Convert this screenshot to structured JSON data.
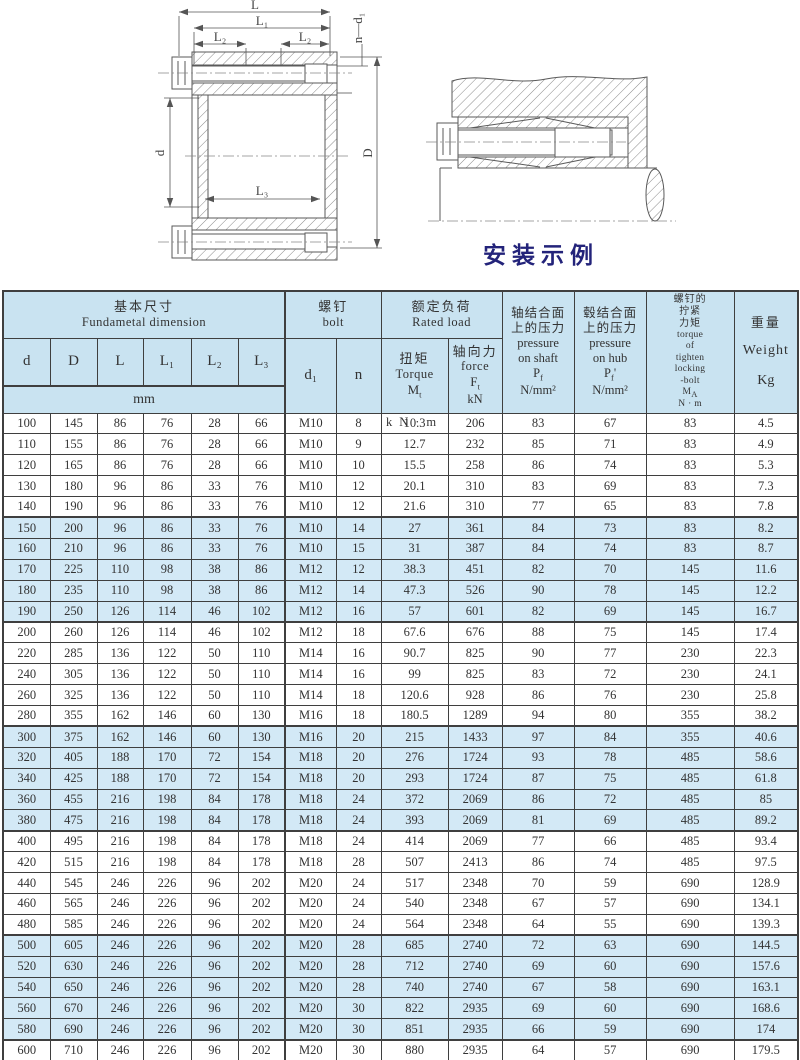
{
  "colors": {
    "header_bg": "#c9e3f1",
    "band_bg": "#d3e9f6",
    "border": "#3f3f3f",
    "text": "#333333",
    "caption": "#23237a",
    "line": "#5a5a5a"
  },
  "drawing": {
    "caption": "安装示例",
    "labels": {
      "L": "L",
      "L1": "L₁",
      "L2a": "L₂",
      "L2b": "L₂",
      "L3": "L₃",
      "nd1": "n—d₁",
      "d": "d",
      "D": "D"
    }
  },
  "table": {
    "header": {
      "basic": {
        "zh": "基本尺寸",
        "en": "Fundametal  dimension",
        "unit": "mm",
        "cols": [
          "d",
          "D",
          "L",
          "L₁",
          "L₂",
          "L₃"
        ]
      },
      "bolt": {
        "zh": "螺钉",
        "en": "bolt",
        "d1": "d₁",
        "n": "n"
      },
      "rated": {
        "zh": "额定负荷",
        "en": "Rated load",
        "torque": {
          "zh": "扭矩",
          "en": "Torque",
          "sym": "M",
          "sub": "t",
          "unit": "kN·m"
        },
        "force": {
          "zh": "轴向力",
          "en": "force",
          "sym": "F",
          "sub": "t",
          "unit": "kN"
        }
      },
      "shaft_pressure": {
        "zh1": "轴结合面",
        "zh2": "上的压力",
        "en1": "pressure",
        "en2": "on shaft",
        "sym": "P",
        "sub": "f",
        "suffix": "",
        "unit": "N/mm²"
      },
      "hub_pressure": {
        "zh1": "毂结合面",
        "zh2": "上的压力",
        "en1": "pressure",
        "en2": "on hub",
        "sym": "P",
        "sub": "f",
        "suffix": "'",
        "unit": "N/mm²"
      },
      "tighten": {
        "zh1": "螺钉的",
        "zh2": "拧紧",
        "zh3": "力矩",
        "en1": "torque",
        "en2": "of",
        "en3": "tighten",
        "en4": "locking",
        "en5": "-bolt",
        "sym": "M",
        "sub": "A",
        "unit": "N · m"
      },
      "weight": {
        "zh": "重量",
        "en": "Weight",
        "unit": "Kg"
      }
    },
    "rows": [
      [
        "100",
        "145",
        "86",
        "76",
        "28",
        "66",
        "M10",
        "8",
        "10.3",
        "206",
        "83",
        "67",
        "83",
        "4.5"
      ],
      [
        "110",
        "155",
        "86",
        "76",
        "28",
        "66",
        "M10",
        "9",
        "12.7",
        "232",
        "85",
        "71",
        "83",
        "4.9"
      ],
      [
        "120",
        "165",
        "86",
        "76",
        "28",
        "66",
        "M10",
        "10",
        "15.5",
        "258",
        "86",
        "74",
        "83",
        "5.3"
      ],
      [
        "130",
        "180",
        "96",
        "86",
        "33",
        "76",
        "M10",
        "12",
        "20.1",
        "310",
        "83",
        "69",
        "83",
        "7.3"
      ],
      [
        "140",
        "190",
        "96",
        "86",
        "33",
        "76",
        "M10",
        "12",
        "21.6",
        "310",
        "77",
        "65",
        "83",
        "7.8"
      ],
      [
        "150",
        "200",
        "96",
        "86",
        "33",
        "76",
        "M10",
        "14",
        "27",
        "361",
        "84",
        "73",
        "83",
        "8.2"
      ],
      [
        "160",
        "210",
        "96",
        "86",
        "33",
        "76",
        "M10",
        "15",
        "31",
        "387",
        "84",
        "74",
        "83",
        "8.7"
      ],
      [
        "170",
        "225",
        "110",
        "98",
        "38",
        "86",
        "M12",
        "12",
        "38.3",
        "451",
        "82",
        "70",
        "145",
        "11.6"
      ],
      [
        "180",
        "235",
        "110",
        "98",
        "38",
        "86",
        "M12",
        "14",
        "47.3",
        "526",
        "90",
        "78",
        "145",
        "12.2"
      ],
      [
        "190",
        "250",
        "126",
        "114",
        "46",
        "102",
        "M12",
        "16",
        "57",
        "601",
        "82",
        "69",
        "145",
        "16.7"
      ],
      [
        "200",
        "260",
        "126",
        "114",
        "46",
        "102",
        "M12",
        "18",
        "67.6",
        "676",
        "88",
        "75",
        "145",
        "17.4"
      ],
      [
        "220",
        "285",
        "136",
        "122",
        "50",
        "110",
        "M14",
        "16",
        "90.7",
        "825",
        "90",
        "77",
        "230",
        "22.3"
      ],
      [
        "240",
        "305",
        "136",
        "122",
        "50",
        "110",
        "M14",
        "16",
        "99",
        "825",
        "83",
        "72",
        "230",
        "24.1"
      ],
      [
        "260",
        "325",
        "136",
        "122",
        "50",
        "110",
        "M14",
        "18",
        "120.6",
        "928",
        "86",
        "76",
        "230",
        "25.8"
      ],
      [
        "280",
        "355",
        "162",
        "146",
        "60",
        "130",
        "M16",
        "18",
        "180.5",
        "1289",
        "94",
        "80",
        "355",
        "38.2"
      ],
      [
        "300",
        "375",
        "162",
        "146",
        "60",
        "130",
        "M16",
        "20",
        "215",
        "1433",
        "97",
        "84",
        "355",
        "40.6"
      ],
      [
        "320",
        "405",
        "188",
        "170",
        "72",
        "154",
        "M18",
        "20",
        "276",
        "1724",
        "93",
        "78",
        "485",
        "58.6"
      ],
      [
        "340",
        "425",
        "188",
        "170",
        "72",
        "154",
        "M18",
        "20",
        "293",
        "1724",
        "87",
        "75",
        "485",
        "61.8"
      ],
      [
        "360",
        "455",
        "216",
        "198",
        "84",
        "178",
        "M18",
        "24",
        "372",
        "2069",
        "86",
        "72",
        "485",
        "85"
      ],
      [
        "380",
        "475",
        "216",
        "198",
        "84",
        "178",
        "M18",
        "24",
        "393",
        "2069",
        "81",
        "69",
        "485",
        "89.2"
      ],
      [
        "400",
        "495",
        "216",
        "198",
        "84",
        "178",
        "M18",
        "24",
        "414",
        "2069",
        "77",
        "66",
        "485",
        "93.4"
      ],
      [
        "420",
        "515",
        "216",
        "198",
        "84",
        "178",
        "M18",
        "28",
        "507",
        "2413",
        "86",
        "74",
        "485",
        "97.5"
      ],
      [
        "440",
        "545",
        "246",
        "226",
        "96",
        "202",
        "M20",
        "24",
        "517",
        "2348",
        "70",
        "59",
        "690",
        "128.9"
      ],
      [
        "460",
        "565",
        "246",
        "226",
        "96",
        "202",
        "M20",
        "24",
        "540",
        "2348",
        "67",
        "57",
        "690",
        "134.1"
      ],
      [
        "480",
        "585",
        "246",
        "226",
        "96",
        "202",
        "M20",
        "24",
        "564",
        "2348",
        "64",
        "55",
        "690",
        "139.3"
      ],
      [
        "500",
        "605",
        "246",
        "226",
        "96",
        "202",
        "M20",
        "28",
        "685",
        "2740",
        "72",
        "63",
        "690",
        "144.5"
      ],
      [
        "520",
        "630",
        "246",
        "226",
        "96",
        "202",
        "M20",
        "28",
        "712",
        "2740",
        "69",
        "60",
        "690",
        "157.6"
      ],
      [
        "540",
        "650",
        "246",
        "226",
        "96",
        "202",
        "M20",
        "28",
        "740",
        "2740",
        "67",
        "58",
        "690",
        "163.1"
      ],
      [
        "560",
        "670",
        "246",
        "226",
        "96",
        "202",
        "M20",
        "30",
        "822",
        "2935",
        "69",
        "60",
        "690",
        "168.6"
      ],
      [
        "580",
        "690",
        "246",
        "226",
        "96",
        "202",
        "M20",
        "30",
        "851",
        "2935",
        "66",
        "59",
        "690",
        "174"
      ],
      [
        "600",
        "710",
        "246",
        "226",
        "96",
        "202",
        "M20",
        "30",
        "880",
        "2935",
        "64",
        "57",
        "690",
        "179.5"
      ]
    ]
  }
}
